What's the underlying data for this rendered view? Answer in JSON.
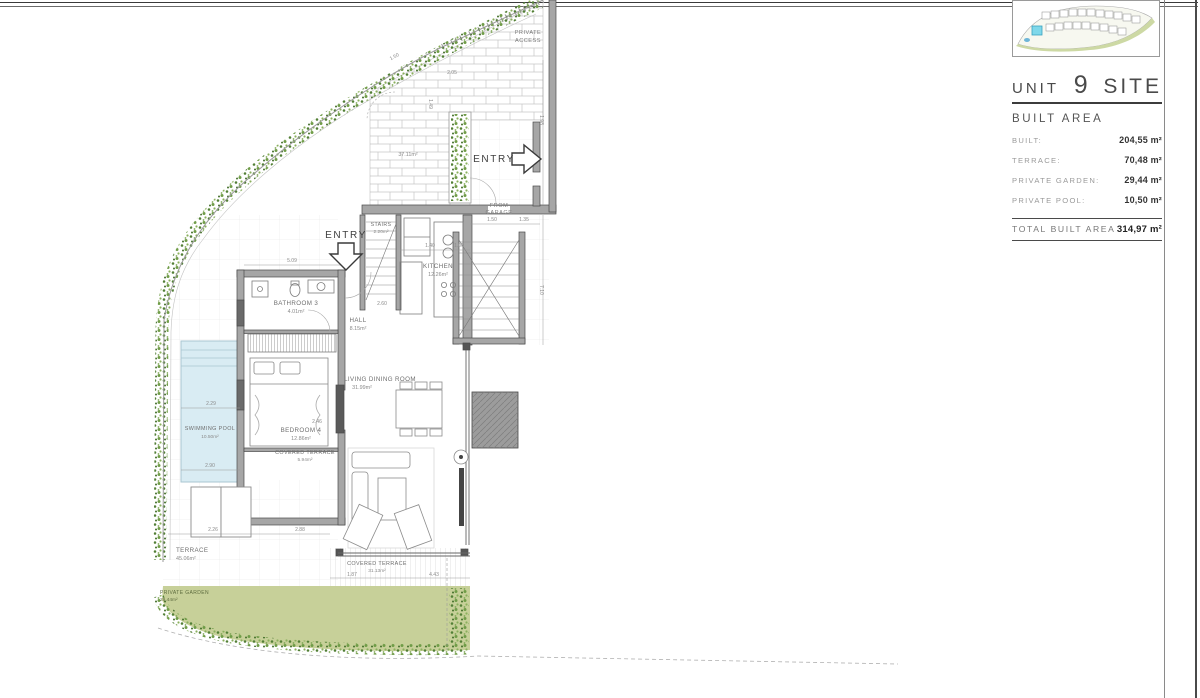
{
  "frame": {
    "unit_label": "UNIT",
    "unit_number": "9",
    "site_label": "SITE"
  },
  "legend": {
    "section_title": "BUILT AREA",
    "rows": [
      {
        "label": "BUILT:",
        "value": "204,55 m²"
      },
      {
        "label": "TERRACE:",
        "value": "70,48 m²"
      },
      {
        "label": "PRIVATE GARDEN:",
        "value": "29,44 m²"
      },
      {
        "label": "PRIVATE POOL:",
        "value": "10,50 m²"
      }
    ],
    "total": {
      "label": "TOTAL BUILT AREA",
      "value": "314,97 m²"
    }
  },
  "plan": {
    "labels": {
      "private_access_line1": "PRIVATE",
      "private_access_line2": "ACCESS",
      "access_area": "37.11m²",
      "entry": "ENTRY",
      "from_garage_line1": "FROM",
      "from_garage_line2": "GARAGE",
      "stairs_name": "STAIRS",
      "stairs_area": "2.20m²",
      "kitchen_name": "KITCHEN",
      "kitchen_area": "12.26m²",
      "hall_name": "HALL",
      "hall_area": "8.15m²",
      "bathroom_name": "BATHROOM 3",
      "bathroom_area": "4.01m²",
      "bedroom_name": "BEDROOM 4",
      "bedroom_area": "12.86m²",
      "living_name": "LIVING DINING ROOM",
      "living_area": "31.99m²",
      "covered_terrace1_name": "COVERED TERRACE",
      "covered_terrace1_area": "5.94m²",
      "covered_terrace2_name": "COVERED TERRACE",
      "covered_terrace2_area": "31.13m²",
      "pool_name": "SWIMMING POOL",
      "pool_area": "10.50m²",
      "terrace_name": "TERRACE",
      "terrace_area": "45.06m²",
      "garden_name": "PRIVATE GARDEN",
      "garden_area": "29.44m²"
    },
    "dimensions": [
      {
        "t": "1.50"
      },
      {
        "t": "2.05"
      },
      {
        "t": "1.49"
      },
      {
        "t": "5.09"
      },
      {
        "t": "1.40"
      },
      {
        "t": "1.06"
      },
      {
        "t": "2.60"
      },
      {
        "t": "2.29"
      },
      {
        "t": "2.90"
      },
      {
        "t": "2.46"
      },
      {
        "t": "2.26"
      },
      {
        "t": "1.87"
      },
      {
        "t": "4.43"
      },
      {
        "t": "7.10"
      },
      {
        "t": "1.98"
      },
      {
        "t": "1.35"
      },
      {
        "t": "1.50"
      },
      {
        "t": "2.88"
      }
    ]
  },
  "colors": {
    "pool": "#d9ecf3",
    "garden": "#c7d099",
    "hedge_dark": "#527f35",
    "hedge_light": "#7da653",
    "wall": "#a6a6a6",
    "unit_highlight": "#7fd8ea"
  }
}
